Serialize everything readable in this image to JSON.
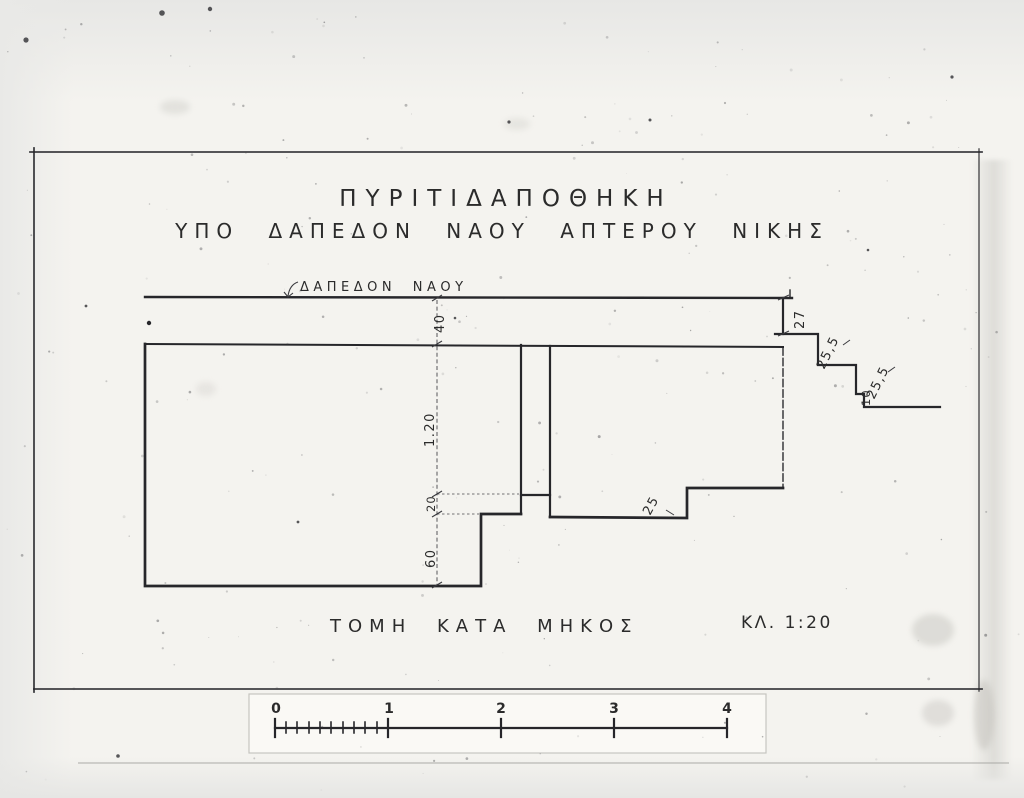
{
  "document": {
    "title": "ΠΥΡΙΤΙΔΑΠΟΘΗΚΗ",
    "subtitle": "ΥΠΟ ΔΑΠΕΔΟΝ ΝΑΟΥ ΑΠΤΕΡΟΥ ΝΙΚΗΣ",
    "floor_label": "ΔΑΠΕΔΟΝ ΝΑΟΥ",
    "caption": "ΤΟΜΗ ΚΑΤΑ ΜΗΚΟΣ",
    "scale_note": "ΚΛ. 1:20"
  },
  "dimensions": {
    "floor_thickness": "40",
    "chamber_height": "1.20",
    "sill_height": "20",
    "pit_depth": "60",
    "chamber_step": "25",
    "stair_riser_1": "27",
    "stair_riser_2": "25,5",
    "stair_riser_3": "25,5",
    "stair_tread": "10"
  },
  "scale_bar": {
    "tick_labels": [
      "0",
      "1",
      "2",
      "3",
      "4"
    ]
  },
  "colors": {
    "ink": "#2b2b2b",
    "paper": "#f4f3ef",
    "background": "#e8e8e6"
  }
}
